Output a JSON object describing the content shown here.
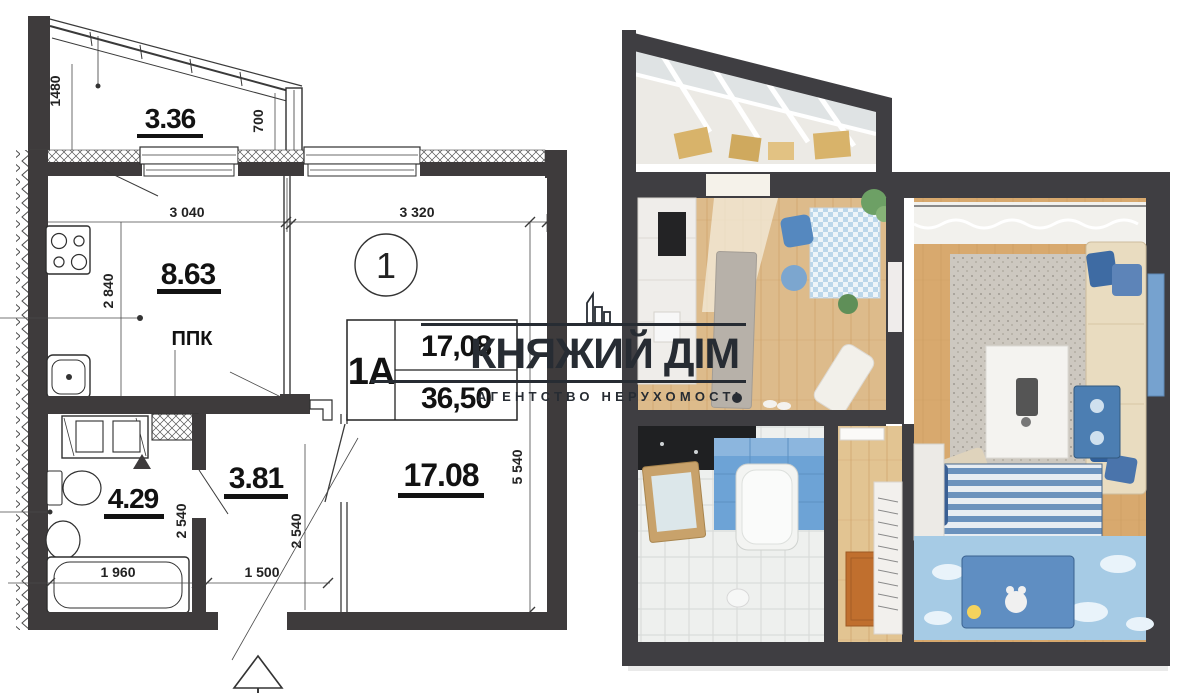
{
  "floor_plan": {
    "unit_label": "1",
    "fire_panel_label": "ППК",
    "areas": {
      "balcony": "3.36",
      "kitchen": "8.63",
      "bathroom": "4.29",
      "hallway": "3.81",
      "living_room": "17.08"
    },
    "stamp": {
      "unit_type": "1А",
      "living_area": "17,08",
      "total_area": "36,50"
    },
    "dims": {
      "balcony_depth": "1480",
      "balcony_window": "700",
      "kitchen_width": "3 040",
      "living_width": "3 320",
      "kitchen_depth": "2 840",
      "bathroom_depth": "2 540",
      "bathtub_length": "1 960",
      "hallway_depth": "2 540",
      "hallway_width": "1 500",
      "living_depth": "5 540"
    }
  },
  "watermark": {
    "brand": "КНЯЖИЙ ДІМ",
    "tagline": "АГЕНТСТВО НЕРУХОМОСТІ",
    "color": "#272c33"
  },
  "photo": {
    "palette": {
      "wall": "#3f3e42",
      "wood_floor": "#ddbb8b",
      "living_floor": "#d8a96e",
      "tile_floor": "#eef0ee",
      "blue_accent": "#4c7eb2",
      "blue_tile": "#6da3d6",
      "light_blue_rug": "#a6cbe5",
      "curtain": "#f2f1ed"
    }
  }
}
